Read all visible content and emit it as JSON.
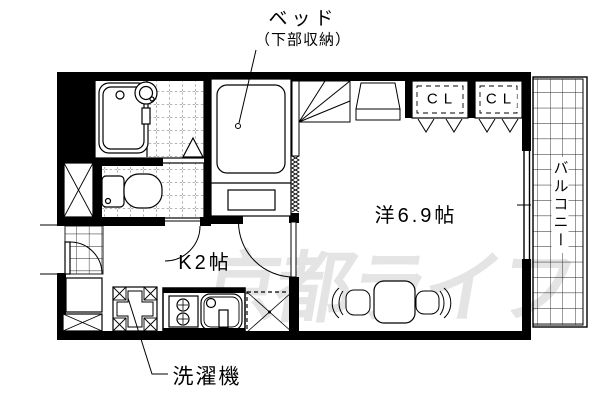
{
  "plan": {
    "bed_label": "ベッド",
    "bed_note": "（下部収納）",
    "closets": [
      "CL",
      "CL"
    ],
    "balcony_label": "バルコニー",
    "main_room_label": "洋6.9帖",
    "kitchen_label": "K2帖",
    "washing_machine_label": "洗濯機",
    "watermark": "京都ライフ"
  },
  "colors": {
    "ink": "#000000",
    "tile_line": "#3a3a3a",
    "watermark": "#e4e4e4",
    "background": "#ffffff"
  },
  "fixtures": [
    "bathtub-icon",
    "wash-basin-icon",
    "toilet-icon",
    "storage-x-box-icon",
    "entrance-door-icon",
    "bathroom-door-icon",
    "washroom-door-icon",
    "kitchen-door-icon",
    "shoe-cabinet-icon",
    "washing-machine-pan-icon",
    "gas-stove-icon",
    "kitchen-sink-icon",
    "refrigerator-space-icon",
    "bed-icon",
    "accordion-curtain-icon",
    "corner-shelf-icon",
    "tv-stand-icon",
    "dining-table-icon",
    "chair-icon",
    "closet-folding-door-icon",
    "sliding-window-icon",
    "balcony-grid-icon"
  ]
}
